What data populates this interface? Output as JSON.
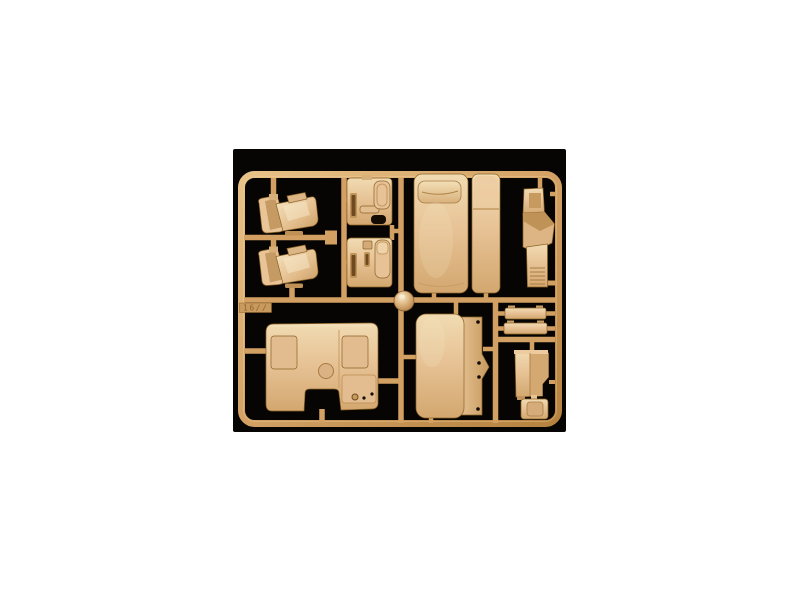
{
  "photo": {
    "alt_text": "Product photo of a tan injection-molded model kit sprue holding truck cab interior parts, on a black background",
    "mold_tag": "16//",
    "colors": {
      "page_background": "#ffffff",
      "photo_background": "#070503",
      "runner": "#d2a063",
      "runner_light": "#ecca92",
      "runner_dark": "#a9783c",
      "part": "#e7c396",
      "part_light": "#f4e3c0",
      "part_dark": "#c1945a",
      "outline": "#8d6227",
      "recess_dark": "#6e4a20",
      "hole_black": "#130b04"
    },
    "parts": [
      {
        "name": "seat-upper",
        "label": "Truck seat (upper)"
      },
      {
        "name": "seat-lower",
        "label": "Truck seat (lower)"
      },
      {
        "name": "door-panel-upper",
        "label": "Door interior panel (upper)"
      },
      {
        "name": "door-panel-lower",
        "label": "Door interior panel (lower)"
      },
      {
        "name": "bunk-bed",
        "label": "Sleeper bunk with pillow"
      },
      {
        "name": "bunk-base",
        "label": "Bunk mattress base panel"
      },
      {
        "name": "dashboard-console",
        "label": "Dashboard console"
      },
      {
        "name": "engine-tunnel-cover",
        "label": "Engine tunnel cover"
      },
      {
        "name": "cab-panel",
        "label": "Cab panel with hinge flange"
      },
      {
        "name": "visor-strip-1",
        "label": "Step / visor strip"
      },
      {
        "name": "visor-strip-2",
        "label": "Step / visor strip"
      },
      {
        "name": "heater-box",
        "label": "Heater box"
      },
      {
        "name": "hatch-panel",
        "label": "Access hatch panel"
      },
      {
        "name": "dome-knob",
        "label": "Dome knob"
      }
    ]
  }
}
